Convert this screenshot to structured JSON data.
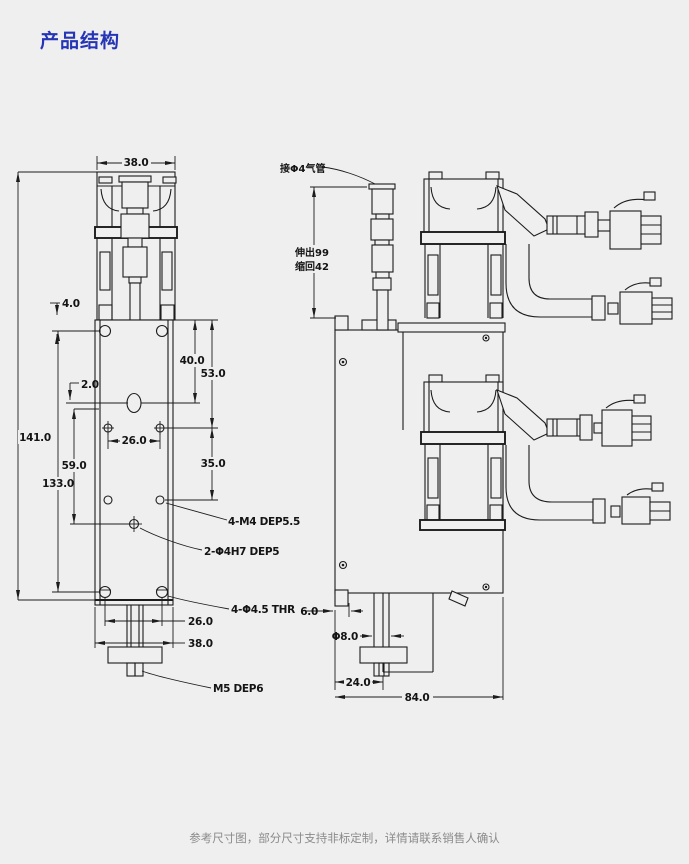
{
  "page": {
    "title": "产品结构",
    "footer": "参考尺寸图，部分尺寸支持非标定制，详情请联系销售人确认",
    "colors": {
      "background": "#efefef",
      "title_blue": "#2535b5",
      "line_black": "#1c1c1c",
      "footer_gray": "#8a8a8a"
    }
  },
  "front_view": {
    "dims": {
      "w_top": "38.0",
      "off4": "4.0",
      "off2": "2.0",
      "v40": "40.0",
      "v53": "53.0",
      "h26": "26.0",
      "v35": "35.0",
      "v59": "59.0",
      "v133": "133.0",
      "v141": "141.0",
      "b26": "26.0",
      "b38": "38.0"
    },
    "notes": {
      "m4": "4-M4 DEP5.5",
      "h7": "2-Φ4H7 DEP5",
      "thr": "4-Φ4.5 THR",
      "m5": "M5 DEP6"
    }
  },
  "side_view": {
    "notes": {
      "air": "接Φ4气管",
      "extend": "伸出99",
      "retract": "缩回42"
    },
    "dims": {
      "d6": "6.0",
      "d8": "Φ8.0",
      "d24": "24.0",
      "d84": "84.0"
    }
  }
}
